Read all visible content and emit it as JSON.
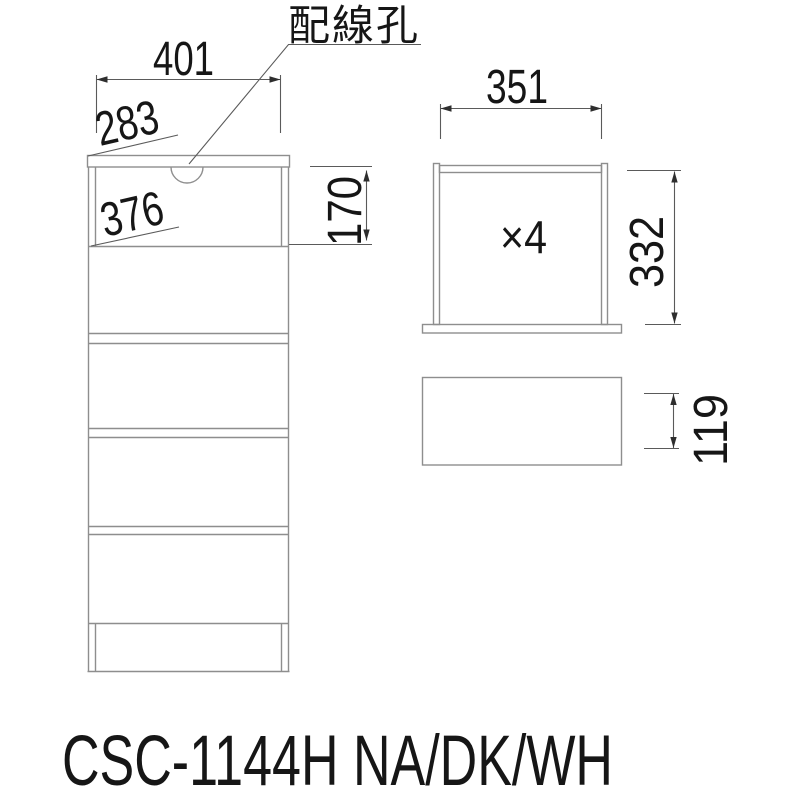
{
  "colors": {
    "background": "#ffffff",
    "object_line": "#8e8e8e",
    "dimension_line": "#5a5a5a",
    "arrow": "#2e2e2e",
    "text": "#161616"
  },
  "annotations": {
    "wiring_hole_label": "配線孔"
  },
  "front_view": {
    "top_width": "401",
    "top_depth": "283",
    "inner_width": "376",
    "open_section_height": "170"
  },
  "drawer_unit": {
    "inner_width": "351",
    "height": "332",
    "quantity": "×4",
    "front_height": "119"
  },
  "footer": {
    "model": "CSC-1144H NA/DK/WH"
  }
}
